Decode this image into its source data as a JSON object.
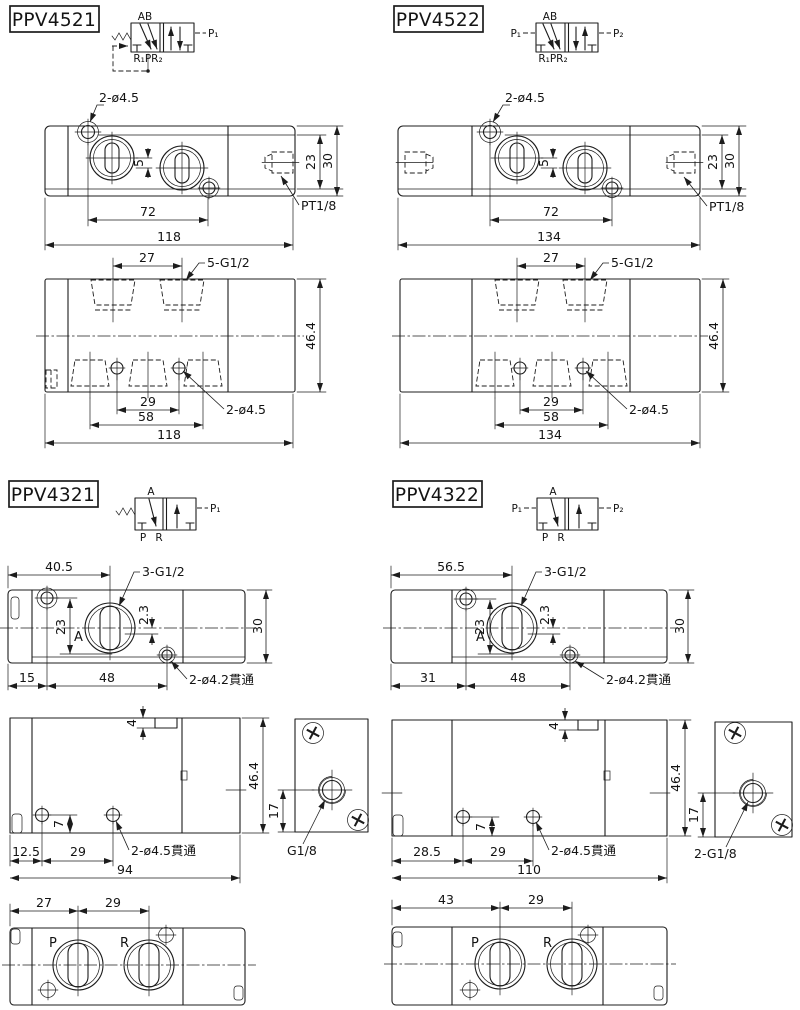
{
  "colors": {
    "line": "#1c1c1c",
    "background": "#ffffff"
  },
  "ppv4521": {
    "model": "PPV4521",
    "symbol": {
      "top": "AB",
      "bottom": "R₁PR₂",
      "right": "P₁"
    },
    "top_view": {
      "hole_callout": "2-ø4.5",
      "dim_5": "5",
      "dim_23": "23",
      "dim_30": "30",
      "dim_72": "72",
      "dim_118": "118",
      "port_callout": "PT1/8"
    },
    "side_view": {
      "dim_27": "27",
      "port_callout": "5-G1/2",
      "dim_46_4": "46.4",
      "dim_29": "29",
      "dim_58": "58",
      "dim_118": "118",
      "hole_callout": "2-ø4.5"
    }
  },
  "ppv4522": {
    "model": "PPV4522",
    "symbol": {
      "top": "AB",
      "bottom": "R₁PR₂",
      "left": "P₁",
      "right": "P₂"
    },
    "top_view": {
      "hole_callout": "2-ø4.5",
      "dim_5": "5",
      "dim_23": "23",
      "dim_30": "30",
      "dim_72": "72",
      "dim_134": "134",
      "port_callout": "PT1/8"
    },
    "side_view": {
      "dim_27": "27",
      "port_callout": "5-G1/2",
      "dim_46_4": "46.4",
      "dim_29": "29",
      "dim_58": "58",
      "dim_134": "134",
      "hole_callout": "2-ø4.5"
    }
  },
  "ppv4321": {
    "model": "PPV4321",
    "symbol": {
      "top": "A",
      "bottom_p": "P",
      "bottom_r": "R",
      "right": "P₁"
    },
    "top_view": {
      "dim_40_5": "40.5",
      "port_callout": "3-G1/2",
      "dim_23": "23",
      "dim_2_3": "2.3",
      "dim_30": "30",
      "label_a": "A",
      "dim_15": "15",
      "dim_48": "48",
      "hole_callout": "2-ø4.2貫通"
    },
    "side_view": {
      "dim_4": "4",
      "dim_46_4": "46.4",
      "dim_7": "7",
      "dim_12_5": "12.5",
      "dim_29": "29",
      "dim_94": "94",
      "hole_callout": "2-ø4.5貫通"
    },
    "end_view": {
      "dim_17": "17",
      "port_callout": "G1/8"
    },
    "bottom_view": {
      "dim_27": "27",
      "dim_29": "29",
      "label_p": "P",
      "label_r": "R"
    }
  },
  "ppv4322": {
    "model": "PPV4322",
    "symbol": {
      "top": "A",
      "bottom_p": "P",
      "bottom_r": "R",
      "left": "P₁",
      "right": "P₂"
    },
    "top_view": {
      "dim_56_5": "56.5",
      "port_callout": "3-G1/2",
      "dim_23": "23",
      "dim_2_3": "2.3",
      "dim_30": "30",
      "label_a": "A",
      "dim_31": "31",
      "dim_48": "48",
      "hole_callout": "2-ø4.2貫通"
    },
    "side_view": {
      "dim_4": "4",
      "dim_46_4": "46.4",
      "dim_7": "7",
      "dim_28_5": "28.5",
      "dim_29": "29",
      "dim_110": "110",
      "hole_callout": "2-ø4.5貫通"
    },
    "end_view": {
      "dim_17": "17",
      "port_callout": "2-G1/8"
    },
    "bottom_view": {
      "dim_43": "43",
      "dim_29": "29",
      "label_p": "P",
      "label_r": "R"
    }
  }
}
